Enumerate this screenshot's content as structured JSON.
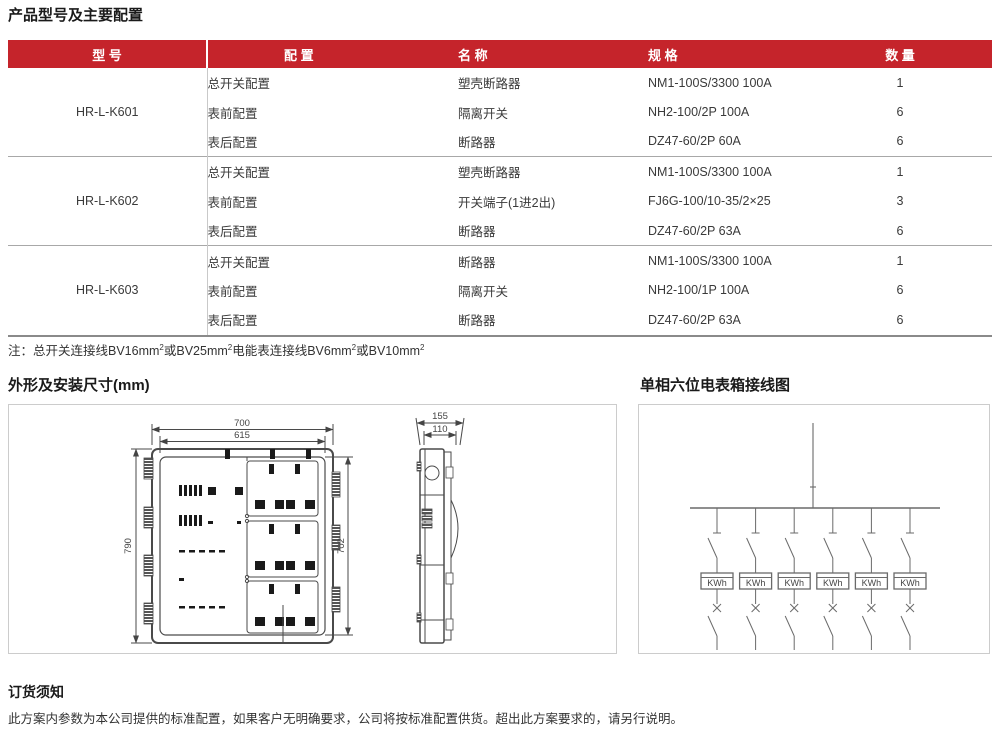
{
  "page_title": "产品型号及主要配置",
  "colors": {
    "accent_red": "#c5242b"
  },
  "table": {
    "headers": {
      "model": "型 号",
      "config": "配 置",
      "name": "名 称",
      "spec": "规 格",
      "qty": "数 量"
    },
    "groups": [
      {
        "model": "HR-L-K601",
        "rows": [
          {
            "config": "总开关配置",
            "name": "塑壳断路器",
            "spec": "NM1-100S/3300 100A",
            "qty": "1"
          },
          {
            "config": "表前配置",
            "name": "隔离开关",
            "spec": "NH2-100/2P 100A",
            "qty": "6"
          },
          {
            "config": "表后配置",
            "name": "断路器",
            "spec": "DZ47-60/2P 60A",
            "qty": "6"
          }
        ]
      },
      {
        "model": "HR-L-K602",
        "rows": [
          {
            "config": "总开关配置",
            "name": "塑壳断路器",
            "spec": "NM1-100S/3300 100A",
            "qty": "1"
          },
          {
            "config": "表前配置",
            "name": "开关端子(1进2出)",
            "spec": "FJ6G-100/10-35/2×25",
            "qty": "3"
          },
          {
            "config": "表后配置",
            "name": "断路器",
            "spec": "DZ47-60/2P 63A",
            "qty": "6"
          }
        ]
      },
      {
        "model": "HR-L-K603",
        "rows": [
          {
            "config": "总开关配置",
            "name": "断路器",
            "spec": "NM1-100S/3300 100A",
            "qty": "1"
          },
          {
            "config": "表前配置",
            "name": "隔离开关",
            "spec": "NH2-100/1P 100A",
            "qty": "6"
          },
          {
            "config": "表后配置",
            "name": "断路器",
            "spec": "DZ47-60/2P 63A",
            "qty": "6"
          }
        ]
      }
    ]
  },
  "note": {
    "p1": "注：总开关连接线BV16mm",
    "s1": "2",
    "p2": "或BV25mm",
    "s2": "2",
    "p3": "电能表连接线BV6mm",
    "s3": "2",
    "p4": "或BV10mm",
    "s4": "2"
  },
  "dimensions_section": {
    "title": "外形及安装尺寸(mm)",
    "dims": {
      "outer_width": "700",
      "inner_width": "615",
      "left_height": "790",
      "right_height": "702",
      "side_depth": "155",
      "side_inner_depth": "110"
    }
  },
  "wiring_section": {
    "title": "单相六位电表箱接线图",
    "meter_label": "KWh",
    "meter_count": "6"
  },
  "ordering_section": {
    "title": "订货须知",
    "text": "此方案内参数为本公司提供的标准配置，如果客户无明确要求，公司将按标准配置供货。超出此方案要求的，请另行说明。"
  }
}
